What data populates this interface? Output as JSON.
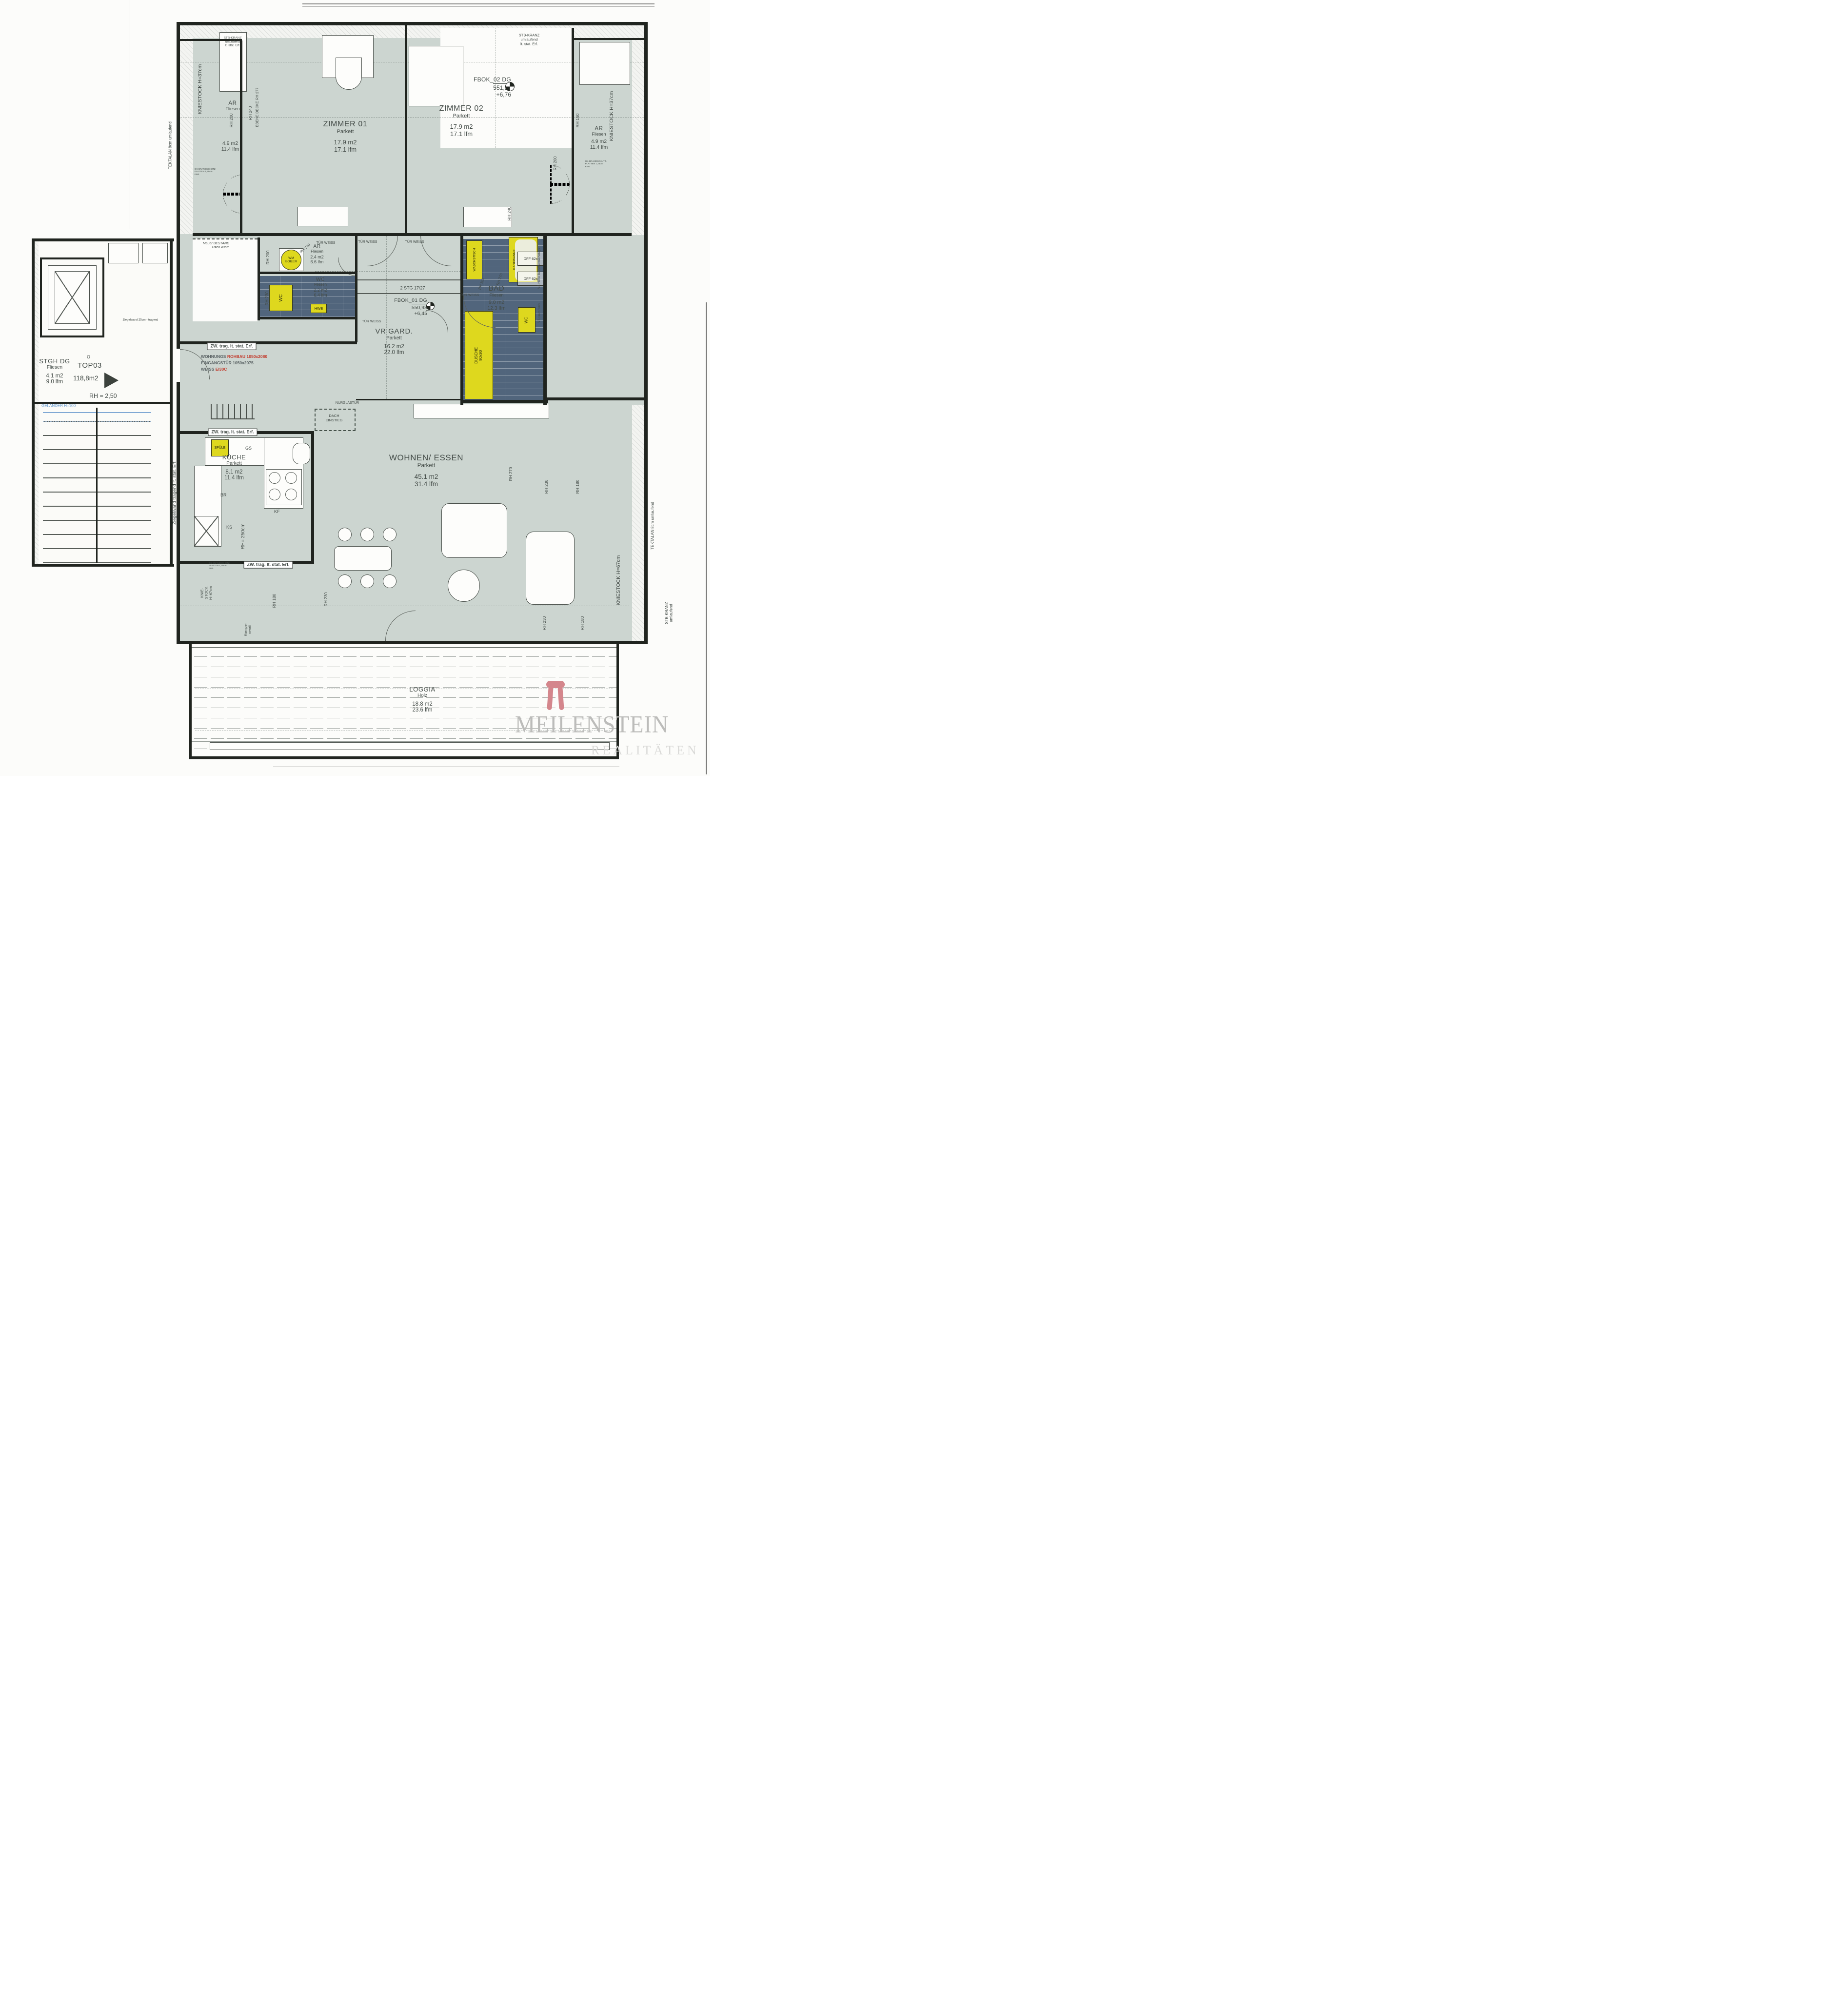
{
  "rooms": [
    {
      "name": "ZIMMER 01",
      "floor": "Parkett",
      "area": "17.9 m2",
      "lfm": "17.1 lfm"
    },
    {
      "name": "ZIMMER 02",
      "floor": "Parkett",
      "area": "17.9 m2",
      "lfm": "17.1 lfm"
    },
    {
      "name": "AR",
      "floor": "Fliesen",
      "area": "4.9 m2",
      "lfm": "11.4 lfm"
    },
    {
      "name": "AR",
      "floor": "Fliesen",
      "area": "4.9 m2",
      "lfm": "11.4 lfm"
    },
    {
      "name": "AR",
      "floor": "Fliesen",
      "area": "2.4 m2",
      "lfm": "6.6 lfm"
    },
    {
      "name": "WC",
      "floor": "Fliesen",
      "area": "2.2 m2",
      "lfm": "6.4 lfm"
    },
    {
      "name": "BAD",
      "floor": "Fliesen",
      "area": "9.0 m2",
      "lfm": "12.3 lfm"
    },
    {
      "name": "VR GARD.",
      "floor": "Parkett",
      "area": "16.2 m2",
      "lfm": "22.0 lfm"
    },
    {
      "name": "KÜCHE",
      "floor": "Parkett",
      "area": "8.1 m2",
      "lfm": "11.4 lfm"
    },
    {
      "name": "WOHNEN/ ESSEN",
      "floor": "Parkett",
      "area": "45.1 m2",
      "lfm": "31.4 lfm"
    },
    {
      "name": "LOGGIA",
      "floor": "Holz",
      "area": "18.8 m2",
      "lfm": "23.6 lfm"
    },
    {
      "name": "STGH DG",
      "floor": "Fliesen",
      "area": "4.1 m2",
      "lfm": "9.0 lfm"
    }
  ],
  "unit": {
    "top": "TOP03",
    "area": "118,8m2",
    "rh": "RH = 2,50",
    "circle_mark": "O"
  },
  "levels": {
    "fbok01": {
      "label": "FBOK_01 DG",
      "elev": "550,93",
      "rel": "+6,45"
    },
    "fbok02": {
      "label": "FBOK_02 DG",
      "elev": "551,24",
      "rel": "+6,76"
    }
  },
  "entrance": {
    "l1a": "WOHNUNGS",
    "l1b": "ROHBAU 1050x2080",
    "l2": "EINGANGSTÜR 1050x2075",
    "l3a": "WEISS",
    "l3b": "EI30C"
  },
  "fixtures": {
    "wm_boiler": "WM\nBOILER",
    "spuele": "SPÜLE",
    "gs": "GS",
    "kf": "KF",
    "br": "BR",
    "ks": "KS",
    "wc_mid": "WC",
    "hwb": "HWB",
    "waschtisch": "WASCHSTISCH",
    "badewanne": "BADEWANNE\n190x90",
    "dff1": "DFF 62x",
    "dff2": "DFF 62x",
    "dusche": "DUSCHE\n90x90",
    "wc_bad": "WC"
  },
  "annotations": {
    "stb-kranz-top-left": "STB-KRANZ\numlaufend\nlt. stat. Erf.",
    "stb-kranz-top-right": "STB-KRANZ\numlaufend\nlt. stat. Erf.",
    "kniestock-37-left": "KNIESTOCK H=37cm",
    "kniestock-37-right": "KNIESTOCK H=37cm",
    "tektalan-left": "TEKTALAN 8cm umlaufend",
    "tektalan-right": "TEKTALAN 8cm umlaufend",
    "stb-kranz-right": "STB-KRANZ\numlaufend",
    "kniestock-67-left": "KNIE-\nSTOCK\nH=67cm",
    "kniestock-67-right": "KNIESTOCK H=67cm",
    "ziegelwand-vertical": "Ziegelwand tragend lt. stat. Erf.",
    "ziegelwand-25": "Ziegelwand 25cm - tragend",
    "zw-trag-1": "ZW. trag. lt. stat. Erf.",
    "zw-trag-2": "ZW. trag. lt. stat. Erf.",
    "zw-trag-3": "ZW. trag. lt. stat. Erf.",
    "mauer-bestand": "Mauer BESTAND\nH=ca 40cm",
    "rh-200-z1": "RH 200",
    "rh-240-z1": "RH 240",
    "ebene-decke-rh-277": "EBENE DECKE RH 277",
    "rh-150": "RH 150",
    "rh-200-z2": "RH 200",
    "rh-240-z2": "RH 240",
    "rh-240-diag": "RH 240",
    "rh-200-ar": "RH 200",
    "rh-230-wc": "RH 230",
    "rh-306-bad": "RH 306",
    "rh-270-bad": "RH 270",
    "rh-270-wohnen": "RH 270",
    "rh-230-wohnen-1": "RH 230",
    "rh-180-wohnen-1": "RH 180",
    "rh-230-wohnen-2": "RH 230",
    "rh-180-wohnen-2": "RH 180",
    "rh-180-kueche": "RH 180",
    "rh-230-kueche": "RH 230",
    "rh-250": "RH= 250cm",
    "tuer-weiss-ar": "TÜR WEISS",
    "tuer-weiss-z1": "TÜR WEISS",
    "tuer-weiss-z2": "TÜR WEISS",
    "tuer-weiss-vr": "TÜR WEISS",
    "tuer-weiss-bad": "TÜR WEISS",
    "stg": "2 STG 17/27",
    "nurglastuer": "NURGLASTÜR",
    "dach-einstieg": "DACH\nEINSTIEG",
    "vs-hoehe": "VS Höhe Badewanne/Ablage",
    "vs-raumhoch": "VS raumhoch",
    "kemper": "Kemper\nventil",
    "gk-left": "GK-BRANDSCHUTZ-\nPLATTEN 1,25cm\nEI90",
    "gk-right": "GK-BRANDSCHUTZ-\nPLATTEN 1,25cm\nEI90",
    "gk-bottom": "GK-BRANDSCHUTZ-\nPLATTEN 1,25cm\nEI90",
    "gelaender": "GELÄNDER H=100"
  },
  "watermark": {
    "brand": "MEILENSTEIN",
    "sub": "REALITÄTEN"
  }
}
